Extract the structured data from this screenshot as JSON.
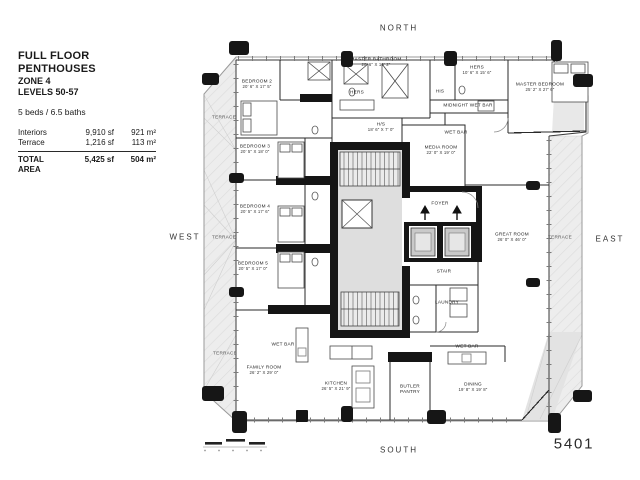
{
  "title_block": {
    "title": "FULL FLOOR PENTHOUSES",
    "zone": "ZONE 4",
    "levels": "LEVELS 50-57",
    "beds_baths": "5 beds / 6.5 baths",
    "area_rows": [
      {
        "label": "Interiors",
        "sf": "9,910 sf",
        "m2": "921 m²"
      },
      {
        "label": "Terrace",
        "sf": "1,216 sf",
        "m2": "113 m²"
      }
    ],
    "total_row": {
      "label": "TOTAL AREA",
      "sf": "5,425 sf",
      "m2": "504 m²"
    }
  },
  "compass": {
    "north": "NORTH",
    "south": "SOUTH",
    "east": "EAST",
    "west": "WEST"
  },
  "unit_number": "5401",
  "colors": {
    "wall": "#151515",
    "line": "#2a2a2a",
    "terrace_fill": "#ececec",
    "core_fill": "#dedede"
  },
  "plan": {
    "labels": [
      {
        "name": "bedroom-2",
        "text": "BEDROOM 2",
        "dims": "20' 6\" X 17' 5\"",
        "x": 257,
        "y": 85
      },
      {
        "name": "master-bathroom",
        "text": "MASTER BATHROOM",
        "dims": "20' 6\" X 16' 2\"",
        "x": 376,
        "y": 63
      },
      {
        "name": "hers-wc",
        "text": "HERS",
        "dims": "",
        "x": 357,
        "y": 93
      },
      {
        "name": "his-closet",
        "text": "HIS",
        "dims": "",
        "x": 440,
        "y": 92
      },
      {
        "name": "hers-closet",
        "text": "HERS",
        "dims": "10' 6\" X 15' 6\"",
        "x": 477,
        "y": 71
      },
      {
        "name": "master-bedroom",
        "text": "MASTER BEDROOM",
        "dims": "25' 2\" X 27' 6\"",
        "x": 540,
        "y": 88
      },
      {
        "name": "midnight-wet-bar",
        "text": "MIDNIGHT WET BAR",
        "dims": "",
        "x": 468,
        "y": 106
      },
      {
        "name": "hs-room",
        "text": "H/S",
        "dims": "18' 6\" X 7' 0\"",
        "x": 381,
        "y": 128
      },
      {
        "name": "wet-bar-media",
        "text": "WET BAR",
        "dims": "",
        "x": 456,
        "y": 133
      },
      {
        "name": "media-room",
        "text": "MEDIA ROOM",
        "dims": "22' 0\" X 19' 0\"",
        "x": 441,
        "y": 151
      },
      {
        "name": "bedroom-3",
        "text": "BEDROOM 3",
        "dims": "20' 5\" X 18' 0\"",
        "x": 255,
        "y": 150
      },
      {
        "name": "bedroom-4",
        "text": "BEDROOM 4",
        "dims": "20' 5\" X 17' 6\"",
        "x": 255,
        "y": 210
      },
      {
        "name": "bedroom-5",
        "text": "BEDROOM 5",
        "dims": "20' 5\" X 17' 0\"",
        "x": 253,
        "y": 267
      },
      {
        "name": "foyer",
        "text": "FOYER",
        "dims": "",
        "x": 440,
        "y": 204
      },
      {
        "name": "great-room",
        "text": "GREAT ROOM",
        "dims": "26' 0\" X 46' 0\"",
        "x": 512,
        "y": 238
      },
      {
        "name": "stair",
        "text": "STAIR",
        "dims": "",
        "x": 444,
        "y": 272
      },
      {
        "name": "laundry",
        "text": "LAUNDRY",
        "dims": "",
        "x": 447,
        "y": 303
      },
      {
        "name": "wet-bar-family",
        "text": "WET BAR",
        "dims": "",
        "x": 283,
        "y": 345
      },
      {
        "name": "family-room",
        "text": "FAMILY ROOM",
        "dims": "26' 2\" X 29' 0\"",
        "x": 264,
        "y": 371
      },
      {
        "name": "kitchen",
        "text": "KITCHEN",
        "dims": "26' 5\" X 21' 9\"",
        "x": 336,
        "y": 387
      },
      {
        "name": "butler-pantry",
        "text": "BUTLER\nPANTRY",
        "dims": "",
        "x": 410,
        "y": 390
      },
      {
        "name": "dining",
        "text": "DINING",
        "dims": "19' 8\" X 19' 8\"",
        "x": 473,
        "y": 388
      },
      {
        "name": "wet-bar-dining",
        "text": "WET BAR",
        "dims": "",
        "x": 467,
        "y": 347
      },
      {
        "name": "terrace-left-top",
        "text": "TERRACE",
        "dims": "",
        "x": 224,
        "y": 118
      },
      {
        "name": "terrace-left-mid",
        "text": "TERRACE",
        "dims": "",
        "x": 224,
        "y": 238
      },
      {
        "name": "terrace-left-bot",
        "text": "TERRACE",
        "dims": "",
        "x": 225,
        "y": 354
      },
      {
        "name": "terrace-right",
        "text": "TERRACE",
        "dims": "",
        "x": 560,
        "y": 238
      }
    ]
  }
}
